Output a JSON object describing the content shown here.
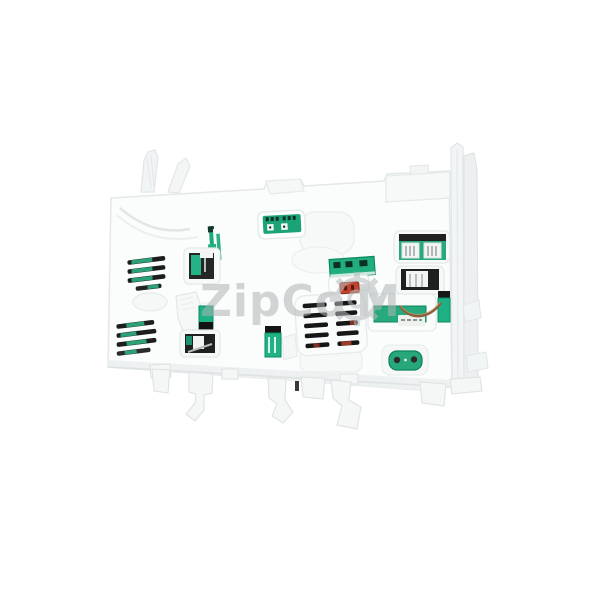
{
  "scene": {
    "type": "product-photo",
    "subject": "White plastic appliance electronic control module housing, tilted view, with green PCB connector windows, black vent slats, red connector slot and mounting legs, on a plain white background",
    "background_color": "#ffffff"
  },
  "watermark": {
    "text_left": "ZipCo",
    "text_right": "M",
    "gear_icon": "gear-outline",
    "color": "#aeb5b5"
  },
  "palette": {
    "plastic_white": "#fbfcfc",
    "plastic_edge": "#e4e8e8",
    "plastic_recess": "#f4f6f6",
    "pcb_green": "#27aa7d",
    "teal_connector": "#1fb287",
    "pcb_green_dark": "#0d875d",
    "slot_black": "#1a1a1a",
    "connector_red": "#c14431",
    "red_slat_accent": "#9c3a28",
    "wire_brown": "#8e5f3b",
    "metal_pin": "#a0a6a8"
  }
}
